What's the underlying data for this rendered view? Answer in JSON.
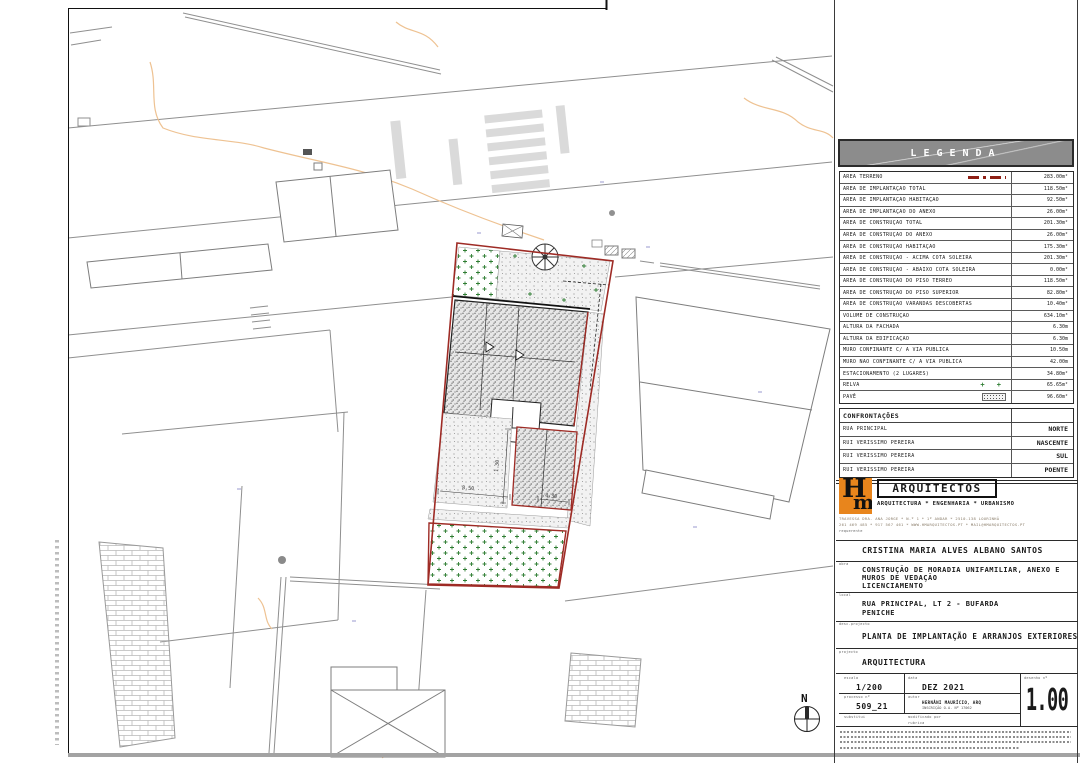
{
  "legend": {
    "title": "LEGENDA",
    "swatch_glyphs": {
      "grass": "+ +"
    },
    "rows": [
      {
        "label": "ÁREA TERRENO",
        "value": "283.00m²",
        "swatch": "terrain"
      },
      {
        "label": "ÁREA DE IMPLANTAÇÃO TOTAL",
        "value": "118.50m²",
        "swatch": null
      },
      {
        "label": "ÁREA DE IMPLANTAÇÃO HABITAÇÃO",
        "value": "92.50m²",
        "swatch": null
      },
      {
        "label": "ÁREA DE IMPLANTAÇÃO DO ANEXO",
        "value": "26.00m²",
        "swatch": null
      },
      {
        "label": "ÁREA DE CONSTRUÇÃO TOTAL",
        "value": "201.30m²",
        "swatch": null
      },
      {
        "label": "ÁREA DE CONSTRUÇÃO DO ANEXO",
        "value": "26.00m²",
        "swatch": null
      },
      {
        "label": "ÁREA DE CONSTRUÇÃO HABITAÇÃO",
        "value": "175.30m²",
        "swatch": null
      },
      {
        "label": "ÁREA DE CONSTRUÇÃO - ACIMA COTA SOLEIRA",
        "value": "201.30m²",
        "swatch": null
      },
      {
        "label": "ÁREA DE CONSTRUÇÃO - ABAIXO COTA SOLEIRA",
        "value": "0.00m²",
        "swatch": null
      },
      {
        "label": "ÁREA DE CONSTRUÇÃO DO PISO TÉRREO",
        "value": "118.50m²",
        "swatch": null
      },
      {
        "label": "ÁREA DE CONSTRUÇÃO DO PISO SUPERIOR",
        "value": "82.80m²",
        "swatch": null
      },
      {
        "label": "ÁREA DE CONSTRUÇÃO VARANDAS DESCOBERTAS",
        "value": "10.40m²",
        "swatch": null
      },
      {
        "label": "VOLUME DE CONSTRUÇÃO",
        "value": "634.10m³",
        "swatch": null
      },
      {
        "label": "ALTURA DA FACHADA",
        "value": "6.30m",
        "swatch": null
      },
      {
        "label": "ALTURA DA EDIFICAÇÃO",
        "value": "6.30m",
        "swatch": null
      },
      {
        "label": "MURO CONFINANTE C/ A VIA PÚBLICA",
        "value": "10.50m",
        "swatch": null
      },
      {
        "label": "MURO NÃO CONFINANTE C/ A VIA PÚBLICA",
        "value": "42.00m",
        "swatch": null
      },
      {
        "label": "ESTACIONAMENTO (2 LUGARES)",
        "value": "34.80m²",
        "swatch": null
      },
      {
        "label": "RELVA",
        "value": "65.65m²",
        "swatch": "grass"
      },
      {
        "label": "PAVÊ",
        "value": "96.60m²",
        "swatch": "pave"
      }
    ]
  },
  "confrontacoes": {
    "title": "CONFRONTAÇÕES",
    "rows": [
      {
        "name": "RUA PRINCIPAL",
        "side": "NORTE"
      },
      {
        "name": "RUI VERISSIMO PEREIRA",
        "side": "NASCENTE"
      },
      {
        "name": "RUI VERISSIMO PEREIRA",
        "side": "SUL"
      },
      {
        "name": "RUI VERISSIMO PEREIRA",
        "side": "POENTE"
      }
    ]
  },
  "firm": {
    "monogram_h": "H",
    "monogram_m": "m",
    "name": "ARQUITECTOS",
    "tagline": "ARQUITECTURA * ENGENHARIA * URBANISMO",
    "address_line1": "TRAVESSA DRA. ANA JORGE * N.º 1 * 1º ANDAR * 2510-138 LOURINHÃ",
    "address_line2": "261 469 485 * 917 567 461 * WWW.HMARQUITECTOS.PT * MAIL@HMARQUITECTOS.PT"
  },
  "titleblock": {
    "requerente_label": "requerente",
    "requerente": "CRISTINA MARIA ALVES ALBANO SANTOS",
    "obra_label": "obra",
    "obra_line1": "CONSTRUÇÃO DE MORADIA UNIFAMILIAR, ANEXO E",
    "obra_line2": "MUROS DE VEDAÇÃO",
    "obra_line3": "LICENCIAMENTO",
    "local_label": "local",
    "local_line1": "RUA PRINCIPAL, LT 2 - BUFARDA",
    "local_line2": "PENICHE",
    "desc_label": "desc.projecto",
    "desc": "PLANTA DE IMPLANTAÇÃO E ARRANJOS EXTERIORES",
    "projecto_label": "projecto",
    "projecto": "ARQUITECTURA",
    "escala_label": "escala",
    "escala": "1/200",
    "data_label": "data",
    "data": "DEZ 2021",
    "desenho_label": "desenho nº",
    "desenho_num": "1.00",
    "processo_label": "processo nº",
    "processo": "509_21",
    "autor_label": "autor",
    "autor_line1": "HERNÂNI MAURÍCIO, ARQ",
    "autor_line2": "INSCRIÇÃO O.A. Nº 17062",
    "substitui_label": "substitui",
    "modificado_label": "modificado por",
    "rubrica_label": "rubrica"
  },
  "plan": {
    "north_label": "N",
    "dims": [
      "8.50",
      "4.30",
      "1.30"
    ]
  }
}
